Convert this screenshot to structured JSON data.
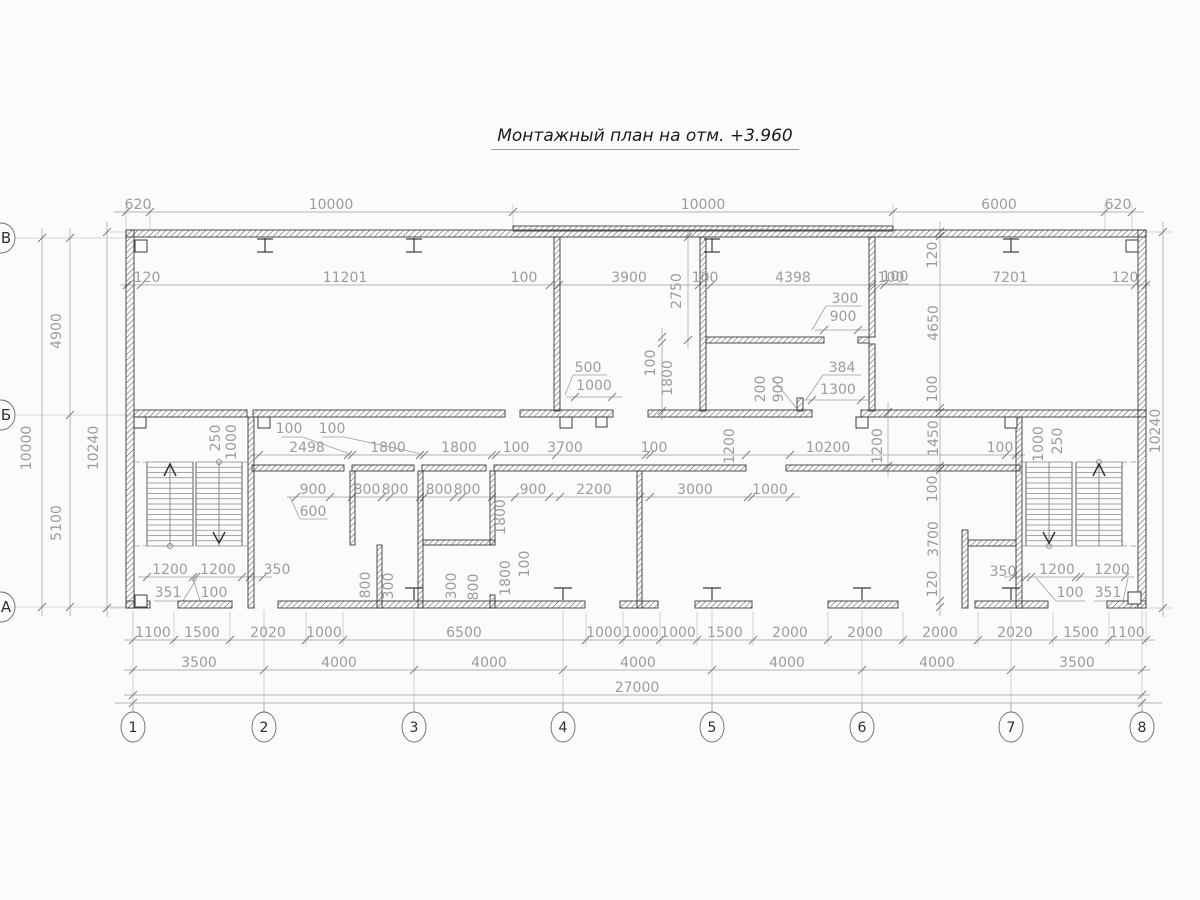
{
  "title": "Монтажный план на отм. +3.960",
  "axes": {
    "rows": [
      {
        "label": "В",
        "y": 238
      },
      {
        "label": "Б",
        "y": 415
      },
      {
        "label": "А",
        "y": 607
      }
    ],
    "cols": [
      {
        "label": "1",
        "x": 133
      },
      {
        "label": "2",
        "x": 264
      },
      {
        "label": "3",
        "x": 414
      },
      {
        "label": "4",
        "x": 563
      },
      {
        "label": "5",
        "x": 712
      },
      {
        "label": "6",
        "x": 862
      },
      {
        "label": "7",
        "x": 1011
      },
      {
        "label": "8",
        "x": 1142
      }
    ],
    "col_bubble_y": 727
  },
  "dims": {
    "labels": [
      {
        "t": "620",
        "x": 138,
        "y": 209
      },
      {
        "t": "10000",
        "x": 331,
        "y": 209
      },
      {
        "t": "10000",
        "x": 703,
        "y": 209
      },
      {
        "t": "6000",
        "x": 999,
        "y": 209
      },
      {
        "t": "620",
        "x": 1118,
        "y": 209
      },
      {
        "t": "120",
        "x": 147,
        "y": 282
      },
      {
        "t": "11201",
        "x": 345,
        "y": 282
      },
      {
        "t": "100",
        "x": 524,
        "y": 282
      },
      {
        "t": "3900",
        "x": 629,
        "y": 282
      },
      {
        "t": "100",
        "x": 705,
        "y": 282
      },
      {
        "t": "4398",
        "x": 793,
        "y": 282
      },
      {
        "t": "100",
        "x": 891,
        "y": 282
      },
      {
        "t": "7201",
        "x": 1010,
        "y": 282
      },
      {
        "t": "120",
        "x": 1125,
        "y": 282
      },
      {
        "t": "2750",
        "x": 681,
        "y": 291,
        "r": true
      },
      {
        "t": "300",
        "x": 845,
        "y": 303
      },
      {
        "t": "900",
        "x": 843,
        "y": 321
      },
      {
        "t": "500",
        "x": 588,
        "y": 372
      },
      {
        "t": "1000",
        "x": 594,
        "y": 390
      },
      {
        "t": "100",
        "x": 655,
        "y": 363,
        "r": true
      },
      {
        "t": "1800",
        "x": 672,
        "y": 378,
        "r": true
      },
      {
        "t": "384",
        "x": 842,
        "y": 372
      },
      {
        "t": "1300",
        "x": 838,
        "y": 394
      },
      {
        "t": "200",
        "x": 765,
        "y": 389,
        "r": true
      },
      {
        "t": "900",
        "x": 783,
        "y": 389,
        "r": true
      },
      {
        "t": "120",
        "x": 937,
        "y": 255,
        "r": true
      },
      {
        "t": "4650",
        "x": 938,
        "y": 323,
        "r": true
      },
      {
        "t": "100",
        "x": 895,
        "y": 281
      },
      {
        "t": "100",
        "x": 937,
        "y": 389,
        "r": true
      },
      {
        "t": "1450",
        "x": 938,
        "y": 438,
        "r": true
      },
      {
        "t": "100",
        "x": 937,
        "y": 489,
        "r": true
      },
      {
        "t": "3700",
        "x": 938,
        "y": 539,
        "r": true
      },
      {
        "t": "120",
        "x": 937,
        "y": 584,
        "r": true
      },
      {
        "t": "250",
        "x": 220,
        "y": 438,
        "r": true
      },
      {
        "t": "1000",
        "x": 236,
        "y": 442,
        "r": true
      },
      {
        "t": "100",
        "x": 289,
        "y": 433
      },
      {
        "t": "100",
        "x": 332,
        "y": 433
      },
      {
        "t": "2498",
        "x": 307,
        "y": 452
      },
      {
        "t": "1800",
        "x": 388,
        "y": 452
      },
      {
        "t": "1800",
        "x": 459,
        "y": 452
      },
      {
        "t": "100",
        "x": 516,
        "y": 452
      },
      {
        "t": "3700",
        "x": 565,
        "y": 452
      },
      {
        "t": "100",
        "x": 654,
        "y": 452
      },
      {
        "t": "10200",
        "x": 828,
        "y": 452
      },
      {
        "t": "100",
        "x": 1000,
        "y": 452
      },
      {
        "t": "1200",
        "x": 734,
        "y": 446,
        "r": true
      },
      {
        "t": "1200",
        "x": 882,
        "y": 446,
        "r": true
      },
      {
        "t": "1000",
        "x": 1043,
        "y": 444,
        "r": true
      },
      {
        "t": "250",
        "x": 1062,
        "y": 441,
        "r": true
      },
      {
        "t": "900",
        "x": 313,
        "y": 494
      },
      {
        "t": "800",
        "x": 367,
        "y": 494
      },
      {
        "t": "800",
        "x": 395,
        "y": 494
      },
      {
        "t": "800",
        "x": 439,
        "y": 494
      },
      {
        "t": "800",
        "x": 467,
        "y": 494
      },
      {
        "t": "900",
        "x": 533,
        "y": 494
      },
      {
        "t": "600",
        "x": 313,
        "y": 516
      },
      {
        "t": "2200",
        "x": 594,
        "y": 494
      },
      {
        "t": "3000",
        "x": 695,
        "y": 494
      },
      {
        "t": "1000",
        "x": 770,
        "y": 494
      },
      {
        "t": "1800",
        "x": 505,
        "y": 517,
        "r": true
      },
      {
        "t": "100",
        "x": 529,
        "y": 564,
        "r": true
      },
      {
        "t": "1800",
        "x": 510,
        "y": 578,
        "r": true
      },
      {
        "t": "300",
        "x": 456,
        "y": 586,
        "r": true
      },
      {
        "t": "800",
        "x": 478,
        "y": 587,
        "r": true
      },
      {
        "t": "800",
        "x": 370,
        "y": 585,
        "r": true
      },
      {
        "t": "300",
        "x": 393,
        "y": 586,
        "r": true
      },
      {
        "t": "1200",
        "x": 170,
        "y": 574
      },
      {
        "t": "1200",
        "x": 218,
        "y": 574
      },
      {
        "t": "350",
        "x": 277,
        "y": 574
      },
      {
        "t": "351",
        "x": 168,
        "y": 597
      },
      {
        "t": "100",
        "x": 214,
        "y": 597
      },
      {
        "t": "350",
        "x": 1003,
        "y": 576
      },
      {
        "t": "1200",
        "x": 1057,
        "y": 574
      },
      {
        "t": "1200",
        "x": 1112,
        "y": 574
      },
      {
        "t": "100",
        "x": 1070,
        "y": 597
      },
      {
        "t": "351",
        "x": 1108,
        "y": 597
      },
      {
        "t": "10000",
        "x": 31,
        "y": 448,
        "r": true
      },
      {
        "t": "4900",
        "x": 61,
        "y": 331,
        "r": true
      },
      {
        "t": "5100",
        "x": 61,
        "y": 523,
        "r": true
      },
      {
        "t": "10240",
        "x": 98,
        "y": 448,
        "r": true
      },
      {
        "t": "10240",
        "x": 1160,
        "y": 431,
        "r": true
      },
      {
        "t": "1100",
        "x": 153,
        "y": 637
      },
      {
        "t": "1500",
        "x": 202,
        "y": 637
      },
      {
        "t": "2020",
        "x": 268,
        "y": 637
      },
      {
        "t": "1000",
        "x": 324,
        "y": 637
      },
      {
        "t": "6500",
        "x": 464,
        "y": 637
      },
      {
        "t": "1000",
        "x": 604,
        "y": 637
      },
      {
        "t": "1000",
        "x": 641,
        "y": 637
      },
      {
        "t": "1000",
        "x": 678,
        "y": 637
      },
      {
        "t": "1500",
        "x": 725,
        "y": 637
      },
      {
        "t": "2000",
        "x": 790,
        "y": 637
      },
      {
        "t": "2000",
        "x": 865,
        "y": 637
      },
      {
        "t": "2000",
        "x": 940,
        "y": 637
      },
      {
        "t": "2020",
        "x": 1015,
        "y": 637
      },
      {
        "t": "1500",
        "x": 1081,
        "y": 637
      },
      {
        "t": "1100",
        "x": 1127,
        "y": 637
      },
      {
        "t": "3500",
        "x": 199,
        "y": 667
      },
      {
        "t": "4000",
        "x": 339,
        "y": 667
      },
      {
        "t": "4000",
        "x": 489,
        "y": 667
      },
      {
        "t": "4000",
        "x": 638,
        "y": 667
      },
      {
        "t": "4000",
        "x": 787,
        "y": 667
      },
      {
        "t": "4000",
        "x": 937,
        "y": 667
      },
      {
        "t": "3500",
        "x": 1077,
        "y": 667
      },
      {
        "t": "27000",
        "x": 637,
        "y": 692
      }
    ]
  }
}
